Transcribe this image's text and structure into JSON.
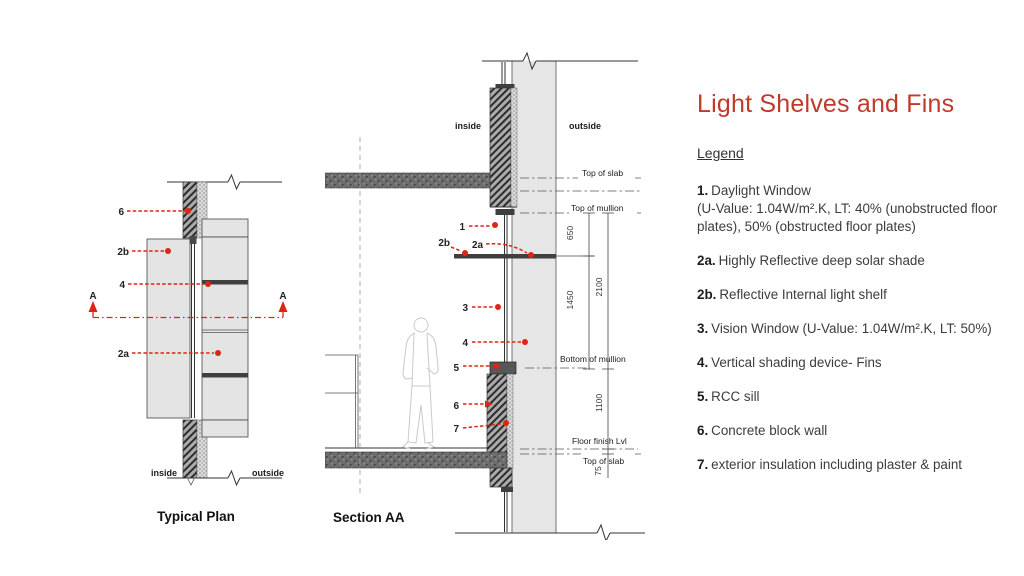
{
  "title": "Light Shelves and Fins",
  "colors": {
    "title_red": "#c0392b",
    "marker_red": "#df2412",
    "wall_gray": "#e4e4e4",
    "slab_gray": "#6e6e6e"
  },
  "plan": {
    "caption": "Typical Plan",
    "inside": "inside",
    "outside": "outside",
    "marker_a": "A",
    "callout_6": "6",
    "callout_2b": "2b",
    "callout_4": "4",
    "callout_2a": "2a"
  },
  "section": {
    "caption": "Section AA",
    "inside": "inside",
    "outside": "outside",
    "level_top_of_slab_upper": "Top of slab",
    "level_top_of_mullion": "Top of mullion",
    "level_bottom_of_mullion": "Bottom of mullion",
    "level_floor_finish": "Floor finish Lvl",
    "level_top_of_slab_lower": "Top of slab",
    "dim_650": "650",
    "dim_1450": "1450",
    "dim_2100": "2100",
    "dim_1100": "1100",
    "dim_75": "75",
    "callout_1": "1",
    "callout_2b": "2b",
    "callout_2a": "2a",
    "callout_3": "3",
    "callout_4": "4",
    "callout_5": "5",
    "callout_6": "6",
    "callout_7": "7"
  },
  "legend": {
    "heading": "Legend",
    "items": [
      {
        "num": "1.",
        "text": "Daylight Window",
        "cont": "(U-Value: 1.04W/m².K, LT: 40% (unobstructed floor plates), 50% (obstructed floor plates)"
      },
      {
        "num": "2a.",
        "text": "Highly Reflective deep solar shade"
      },
      {
        "num": "2b.",
        "text": "Reflective Internal light shelf"
      },
      {
        "num": "3.",
        "text": "Vision Window (U-Value: 1.04W/m².K, LT: 50%)"
      },
      {
        "num": "4.",
        "text": "Vertical shading device- Fins"
      },
      {
        "num": "5.",
        "text": "RCC sill"
      },
      {
        "num": "6.",
        "text": "Concrete block wall"
      },
      {
        "num": "7.",
        "text": "exterior insulation including plaster & paint"
      }
    ]
  }
}
